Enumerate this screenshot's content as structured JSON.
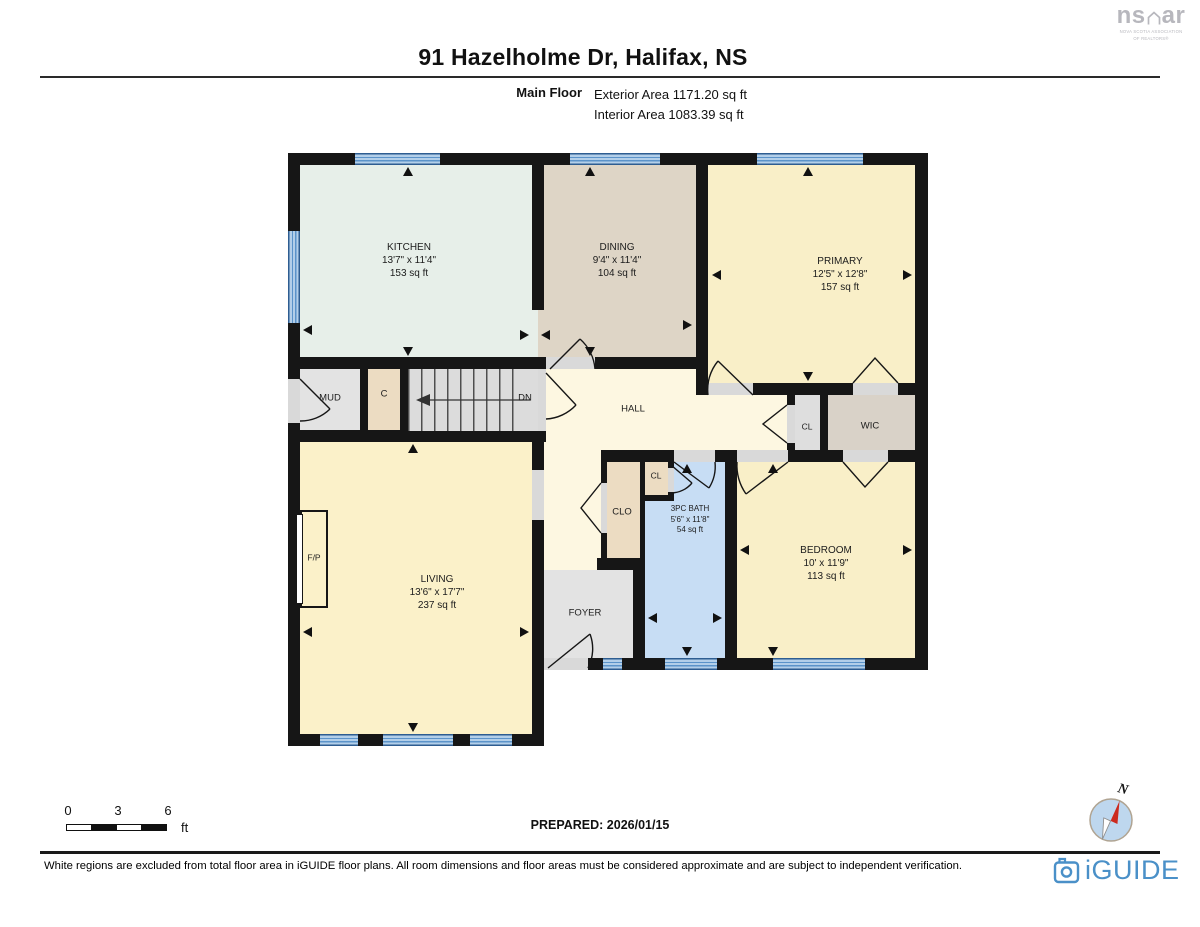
{
  "header": {
    "title": "91 Hazelholme Dr, Halifax, NS",
    "floor_label": "Main Floor",
    "exterior_area": "Exterior Area 1171.20 sq ft",
    "interior_area": "Interior Area 1083.39 sq ft"
  },
  "nsar_logo": {
    "ns": "ns",
    "ar": "ar",
    "subtitle_line1": "NOVA SCOTIA ASSOCIATION",
    "subtitle_line2": "OF REALTORS®"
  },
  "rooms": {
    "kitchen": {
      "name": "KITCHEN",
      "dims": "13'7\" x 11'4\"",
      "area": "153 sq ft"
    },
    "dining": {
      "name": "DINING",
      "dims": "9'4\" x 11'4\"",
      "area": "104 sq ft"
    },
    "primary": {
      "name": "PRIMARY",
      "dims": "12'5\" x 12'8\"",
      "area": "157 sq ft"
    },
    "living": {
      "name": "LIVING",
      "dims": "13'6\" x 17'7\"",
      "area": "237 sq ft"
    },
    "bath": {
      "name": "3PC BATH",
      "dims": "5'6\" x 11'8\"",
      "area": "54 sq ft"
    },
    "bedroom": {
      "name": "BEDROOM",
      "dims": "10' x 11'9\"",
      "area": "113 sq ft"
    },
    "mud": {
      "name": "MUD"
    },
    "closet_c": {
      "name": "C"
    },
    "stairs_dn": {
      "name": "DN"
    },
    "hall": {
      "name": "HALL"
    },
    "cl_hall": {
      "name": "CL"
    },
    "wic": {
      "name": "WIC"
    },
    "clo": {
      "name": "CLO"
    },
    "cl_bath": {
      "name": "CL"
    },
    "fireplace": {
      "name": "F/P"
    },
    "foyer": {
      "name": "FOYER"
    }
  },
  "scale_bar": {
    "tick0": "0",
    "tick3": "3",
    "tick6": "6",
    "unit": "ft"
  },
  "compass": {
    "north": "N"
  },
  "prepared_label": "PREPARED: 2026/01/15",
  "footer": {
    "disclaimer": "White regions are excluded from total floor area in iGUIDE floor plans. All room dimensions and floor areas must be considered approximate and are subject to independent verification.",
    "brand": "iGUIDE"
  },
  "colors": {
    "wall_black": "#161616",
    "window_blue": "#5b93c9",
    "bath_blue": "#c7ddf4",
    "room_yellow": "#f9efc8",
    "kitchen_mint": "#e7efe9",
    "dining_tan": "#ded5c6",
    "brand_blue": "#4a90c8",
    "compass_red": "#cc2a1e"
  }
}
